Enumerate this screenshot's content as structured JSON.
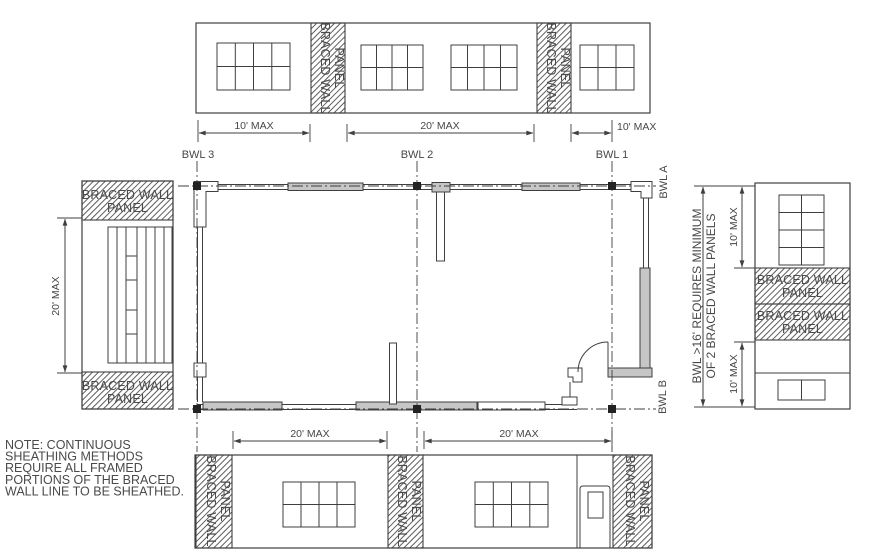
{
  "labels": {
    "bwl1": "BWL 1",
    "bwl2": "BWL 2",
    "bwl3": "BWL 3",
    "bwl_a": "BWL A",
    "bwl_b": "BWL B",
    "braced_line1": "BRACED WALL",
    "braced_line2": "PANEL",
    "requirement_line1": "BWL >16' REQUIRES MINIMUM",
    "requirement_line2": "OF 2 BRACED WALL PANELS"
  },
  "dimensions": {
    "top": [
      "10' MAX",
      "20' MAX",
      "10' MAX"
    ],
    "bottom": [
      "20' MAX",
      "20' MAX"
    ],
    "left": "20' MAX",
    "right": [
      "10' MAX",
      "10' MAX"
    ]
  },
  "note_lines": [
    "NOTE: CONTINUOUS",
    "SHEATHING METHODS",
    "REQUIRE ALL FRAMED",
    "PORTIONS OF THE BRACED",
    "WALL LINE TO BE SHEATHED."
  ],
  "colors": {
    "line": "#3f3f3f",
    "text": "#474747",
    "wall_fill": "#c6c6c6",
    "node_fill": "#222222",
    "background": "#ffffff"
  }
}
